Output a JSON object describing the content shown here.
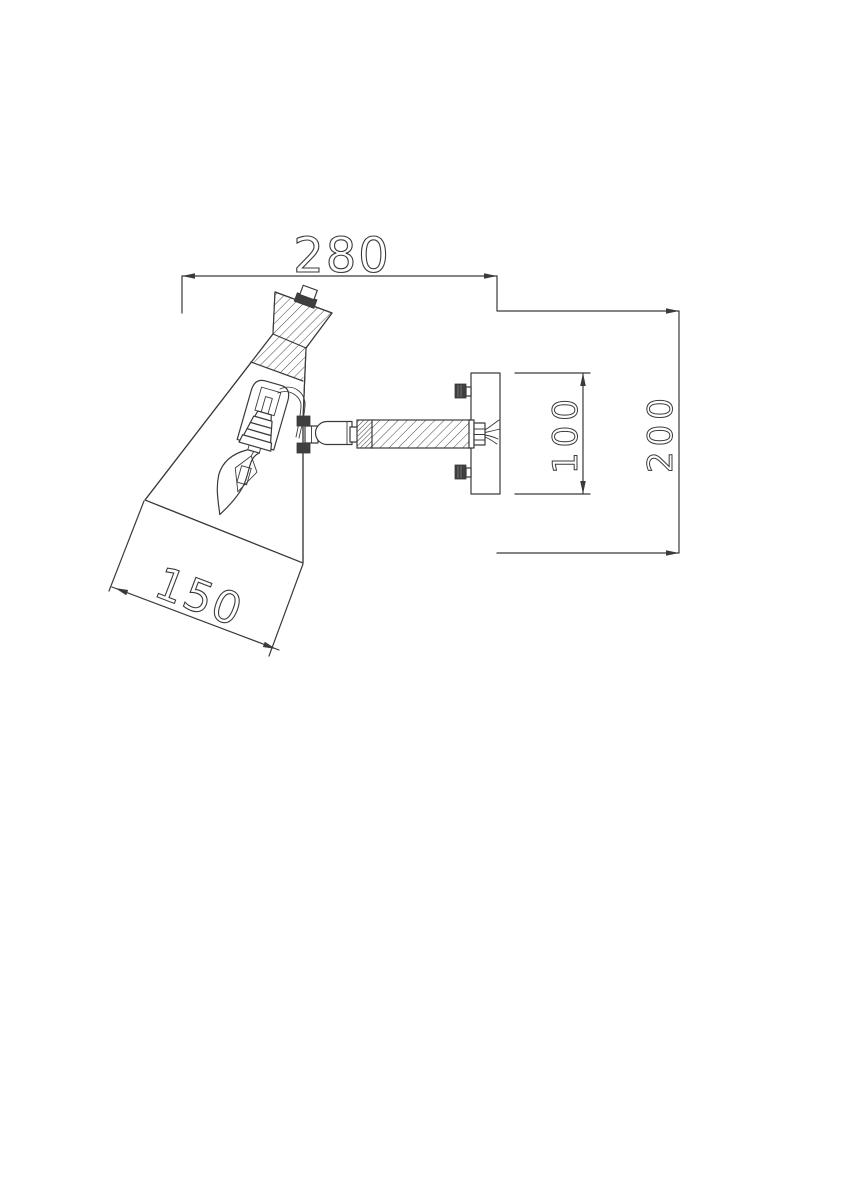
{
  "page": {
    "background_color": "#ffffff"
  },
  "colors": {
    "line": "#3a3a3a",
    "dark_fill": "#3f3f3f",
    "background": "#ffffff"
  },
  "drawing": {
    "kind": "technical-dimension-drawing",
    "subject": "wall-mounted-spot-lamp-side-view",
    "dimensions": {
      "top_width": "280",
      "overall_height": "200",
      "backplate_height": "100",
      "shade_opening_width": "150"
    }
  }
}
